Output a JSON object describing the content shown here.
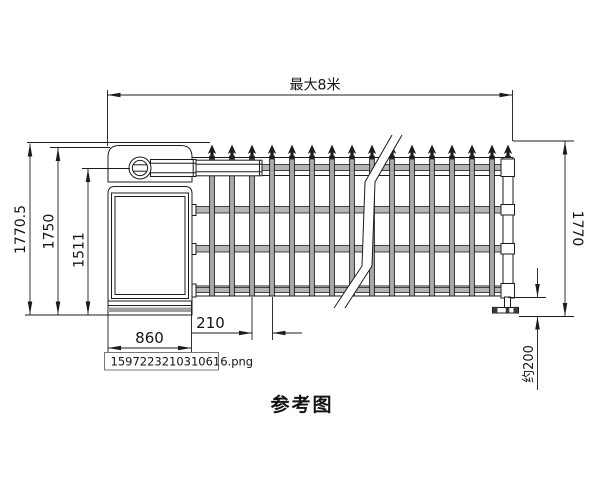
{
  "drawing": {
    "caption": "参考图",
    "filename": "1597223210310616.png",
    "dims": {
      "max_width": "最大8米",
      "total_height": "1770.5",
      "cabinet_height": "1750",
      "arm_height": "1511",
      "fence_height": "1770",
      "cabinet_width": "860",
      "bar_spacing": "210",
      "ground_gap": "约200"
    },
    "colors": {
      "line": "#1c1c1c",
      "metal_gray": "#a9a9a9",
      "background": "#ffffff"
    }
  }
}
